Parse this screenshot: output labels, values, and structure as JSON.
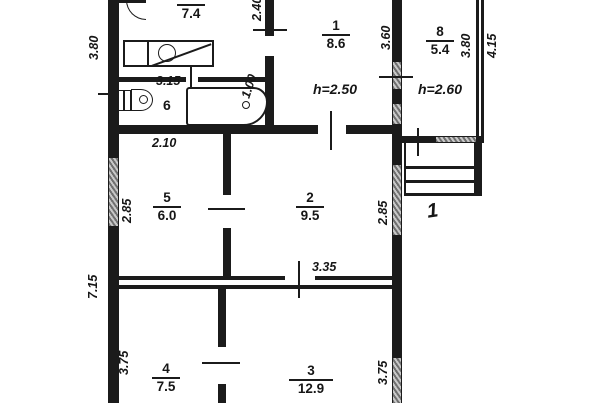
{
  "drawing": {
    "kind": "floor-plan"
  },
  "rooms": {
    "r7": {
      "number": "7",
      "area": "7.4"
    },
    "r1": {
      "number": "1",
      "area": "8.6"
    },
    "r8": {
      "number": "8",
      "area": "5.4"
    },
    "r6": {
      "number": "6"
    },
    "r5": {
      "number": "5",
      "area": "6.0"
    },
    "r2": {
      "number": "2",
      "area": "9.5"
    },
    "r4": {
      "number": "4",
      "area": "7.5"
    },
    "r3": {
      "number": "3",
      "area": "12.9"
    }
  },
  "heights": {
    "main": "h=2.50",
    "annex": "h=2.60"
  },
  "porch": {
    "label": "1"
  },
  "dimensions": {
    "left_top": "3.80",
    "left_bottom": "7.15",
    "room5_left": "2.85",
    "room4_left": "3.75",
    "room5_top": "2.10",
    "bath_width": "3.15",
    "tub": "1.00",
    "top_mid": "2.40",
    "room1_right": "3.60",
    "room8_inner": "3.80",
    "room8_outer": "4.15",
    "room2_right": "2.85",
    "room2_bottom": "3.35",
    "room3_right": "3.75"
  },
  "colors": {
    "wall": "#1b1b1b",
    "window": "#9a9a9a",
    "background": "#ffffff"
  }
}
